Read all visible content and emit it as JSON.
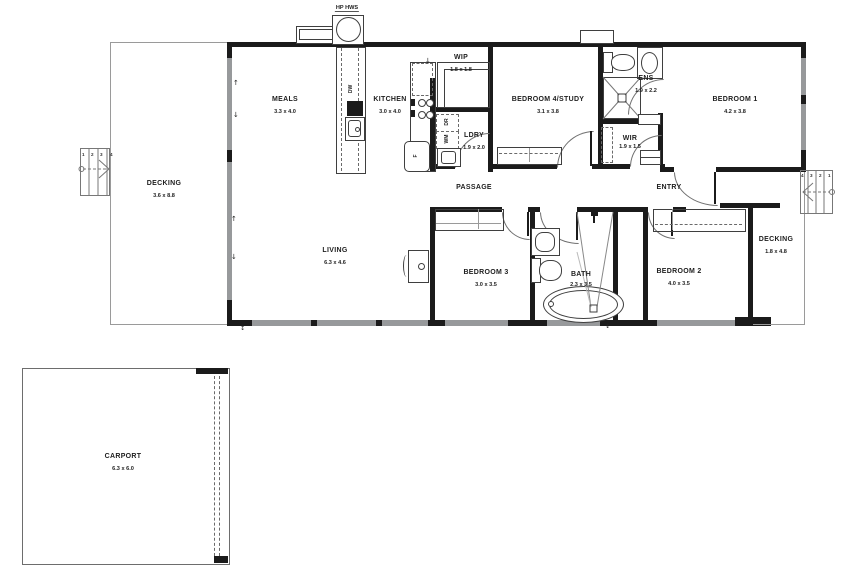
{
  "labels": {
    "hws": "HP HWS",
    "meals": {
      "name": "MEALS",
      "dims": "3.3 x 4.0"
    },
    "kitchen": {
      "name": "KITCHEN",
      "dims": "3.0 x 4.0"
    },
    "wip": {
      "name": "WIP",
      "dims": "1.8 x 1.8"
    },
    "bed4": {
      "name": "BEDROOM 4/STUDY",
      "dims": "3.1 x 3.8"
    },
    "ens": {
      "name": "ENS",
      "dims": "1.9 x 2.2"
    },
    "bed1": {
      "name": "BEDROOM 1",
      "dims": "4.2 x 3.8"
    },
    "ldry": {
      "name": "LDRY",
      "dims": "1.9 x 2.0"
    },
    "wir": {
      "name": "WIR",
      "dims": "1.9 x 1.5"
    },
    "passage": {
      "name": "PASSAGE"
    },
    "entry": {
      "name": "ENTRY"
    },
    "living": {
      "name": "LIVING",
      "dims": "6.3 x 4.6"
    },
    "bed3": {
      "name": "BEDROOM 3",
      "dims": "3.0 x 3.5"
    },
    "bath": {
      "name": "BATH",
      "dims": "2.3 x 3.5"
    },
    "bed2": {
      "name": "BEDROOM 2",
      "dims": "4.0 x 3.5"
    },
    "decking_left": {
      "name": "DECKING",
      "dims": "3.6 x 8.8"
    },
    "decking_right": {
      "name": "DECKING",
      "dims": "1.8 x 4.8"
    },
    "carport": {
      "name": "CARPORT",
      "dims": "6.3 x 6.0"
    }
  },
  "appliances": {
    "dishwasher": "DW",
    "fridge": "F",
    "washing_machine": "WM",
    "dryer": "DR"
  },
  "steps": {
    "left": [
      "1",
      "2",
      "3",
      "4"
    ],
    "right": [
      "4",
      "3",
      "2",
      "1"
    ]
  },
  "markers": {
    "arrow_up": "↑",
    "arrow_down": "↓",
    "arrow_updown": "↕"
  },
  "colors": {
    "wall": "#1b1b1b",
    "window": "#97999b",
    "outline": "#9a9a9a",
    "text": "#1e1e1e"
  }
}
